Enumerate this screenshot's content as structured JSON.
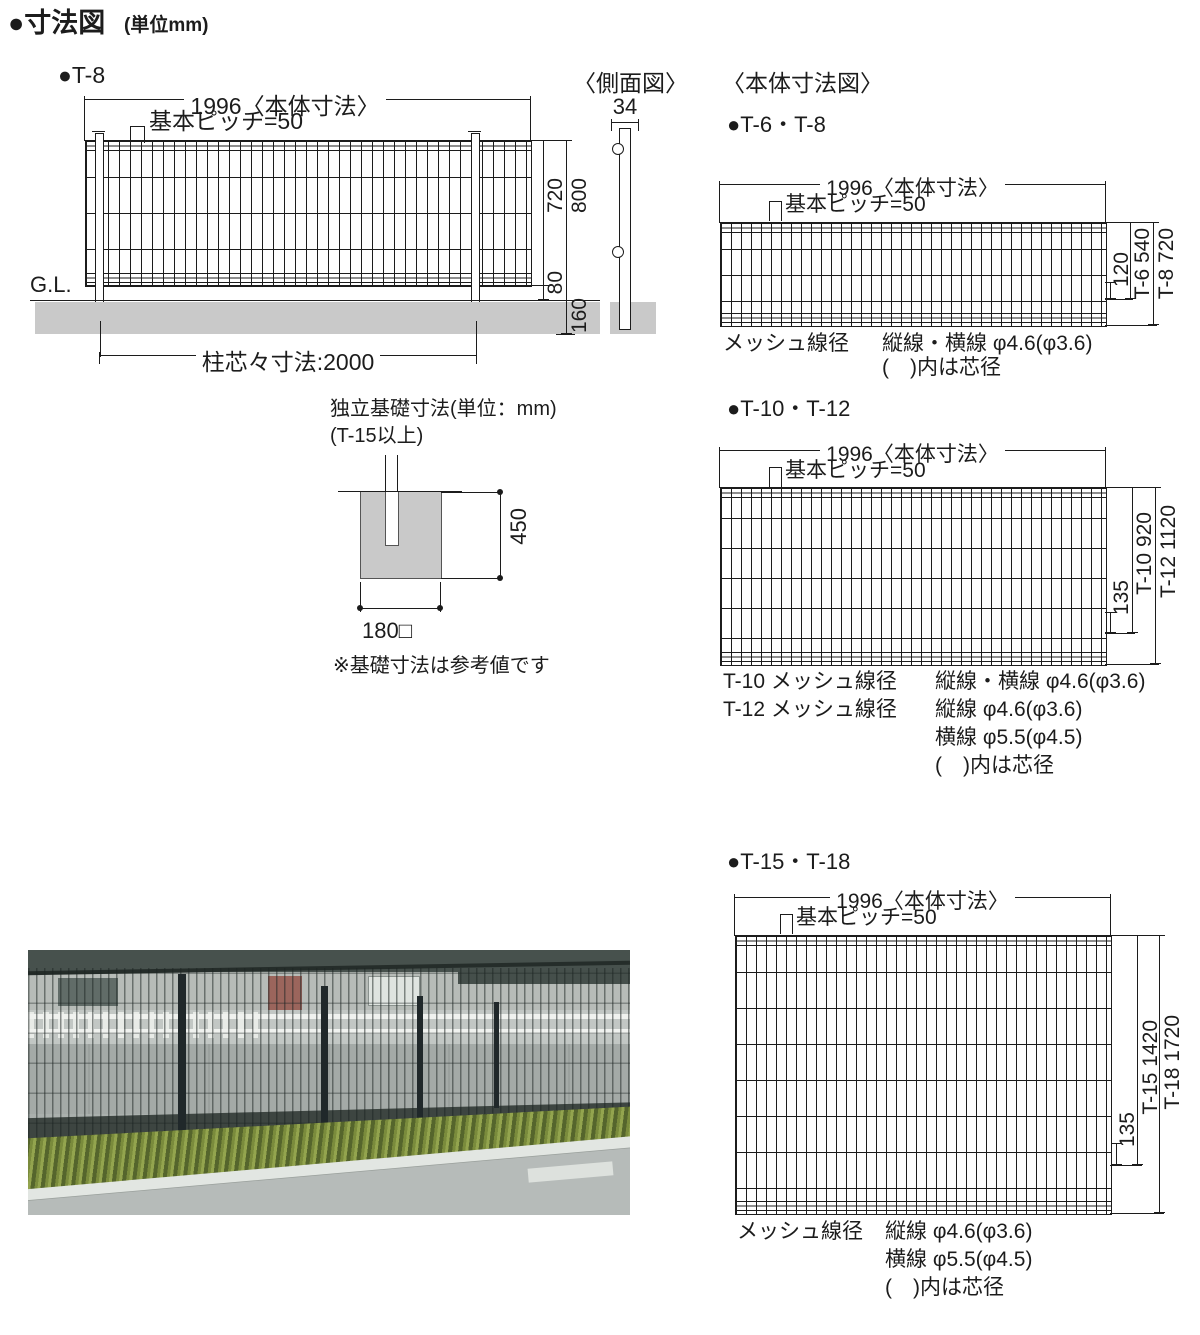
{
  "header": {
    "title": "●寸法図",
    "unit": "(単位mm)"
  },
  "front_view": {
    "label": "●T-8",
    "dim_body_width": "1996〈本体寸法〉",
    "dim_pitch": "基本ピッチ=50",
    "dim_mesh_height": "720",
    "dim_total_height": "800",
    "dim_bottom_gap": "80",
    "dim_embed_depth": "160",
    "gl": "G.L.",
    "dim_post_pitch": "柱芯々寸法:2000"
  },
  "side_view": {
    "title": "〈側面図〉",
    "dim_post_width": "34"
  },
  "body_section": {
    "title": "〈本体寸法図〉",
    "t6_t8": {
      "label": "●T-6・T-8",
      "dim_body_width": "1996〈本体寸法〉",
      "dim_pitch": "基本ピッチ=50",
      "dim_inner": "120",
      "dim_h1": "T-6 540",
      "dim_h2": "T-8 720",
      "spec_label": "メッシュ線径",
      "spec_row1_value": "縦線・横線 φ4.6(φ3.6)",
      "spec_note": "(　)内は芯径"
    },
    "t10_t12": {
      "label": "●T-10・T-12",
      "dim_body_width": "1996〈本体寸法〉",
      "dim_pitch": "基本ピッチ=50",
      "dim_inner": "135",
      "dim_h1": "T-10 920",
      "dim_h2": "T-12 1120",
      "spec_row1_label": "T-10 メッシュ線径",
      "spec_row1_value": "縦線・横線 φ4.6(φ3.6)",
      "spec_row2_label": "T-12 メッシュ線径",
      "spec_row2_value": "縦線 φ4.6(φ3.6)",
      "spec_row3_value": "横線 φ5.5(φ4.5)",
      "spec_note": "(　)内は芯径"
    },
    "t15_t18": {
      "label": "●T-15・T-18",
      "dim_body_width": "1996〈本体寸法〉",
      "dim_pitch": "基本ピッチ=50",
      "dim_inner": "135",
      "dim_h1": "T-15 1420",
      "dim_h2": "T-18 1720",
      "spec_label": "メッシュ線径",
      "spec_row1_value": "縦線 φ4.6(φ3.6)",
      "spec_row2_value": "横線 φ5.5(φ4.5)",
      "spec_note": "(　)内は芯径"
    }
  },
  "foundation": {
    "title": "独立基礎寸法(単位：mm)",
    "subtitle": "(T-15以上)",
    "dim_depth": "450",
    "dim_width": "180□",
    "note": "※基礎寸法は参考値です"
  }
}
